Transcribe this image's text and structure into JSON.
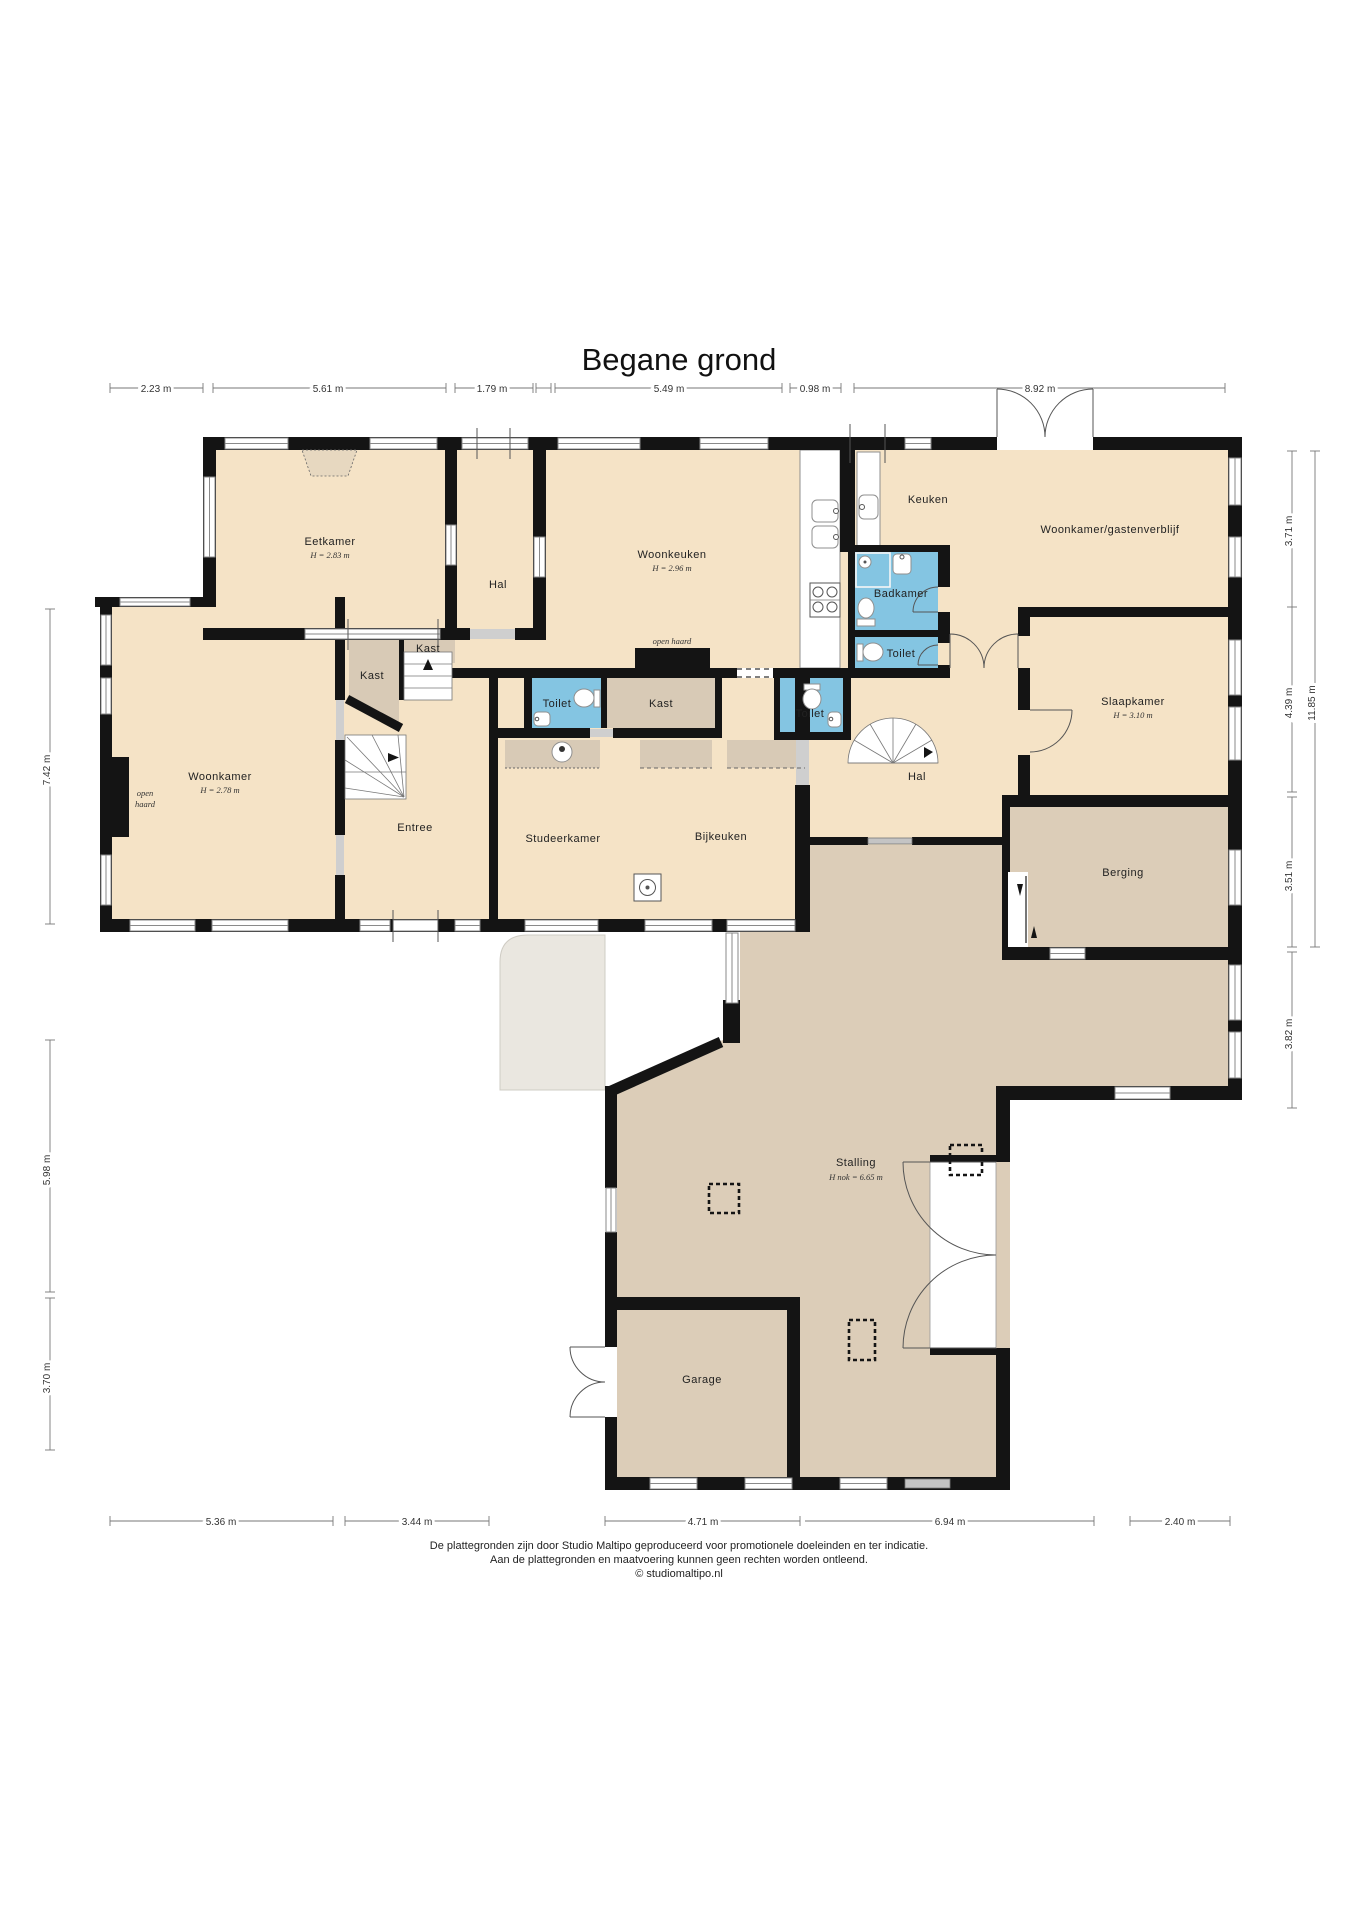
{
  "title": "Begane grond",
  "footer": {
    "line1": "De plattegronden zijn door Studio Maltipo geproduceerd voor promotionele doeleinden en ter indicatie.",
    "line2": "Aan de plattegronden en maatvoering kunnen geen rechten worden ontleend.",
    "line3": "© studiomaltipo.nl"
  },
  "colors": {
    "floor": "#f5e3c6",
    "floor_dark": "#dccdb8",
    "closet": "#d8cab6",
    "wet_room": "#84c5e2",
    "wall": "#141414",
    "outside": "#eae7e0",
    "chimney": "#e7d8c0"
  },
  "rooms": {
    "eetkamer": {
      "label": "Eetkamer",
      "height": "H = 2.83 m"
    },
    "hal_boven": {
      "label": "Hal"
    },
    "woonkeuken": {
      "label": "Woonkeuken",
      "height": "H = 2.96 m"
    },
    "open_haard_keuken": {
      "label": "open haard"
    },
    "keuken": {
      "label": "Keuken"
    },
    "badkamer": {
      "label": "Badkamer"
    },
    "toilet_badkamer": {
      "label": "Toilet"
    },
    "woonkamer_gastenverblijf": {
      "label": "Woonkamer/gastenverblijf"
    },
    "slaapkamer": {
      "label": "Slaapkamer",
      "height": "H = 3.10 m"
    },
    "kast_trap_boven": {
      "label": "Kast"
    },
    "kast_trap": {
      "label": "Kast"
    },
    "woonkamer": {
      "label": "Woonkamer",
      "height": "H = 2.78 m",
      "open_haard_1": "open",
      "open_haard_2": "haard"
    },
    "entree": {
      "label": "Entree"
    },
    "toilet_gang_links": {
      "label": "Toilet"
    },
    "kast_gang": {
      "label": "Kast"
    },
    "toilet_gang_rechts": {
      "label": "Toilet"
    },
    "studeerkamer": {
      "label": "Studeerkamer"
    },
    "bijkeuken": {
      "label": "Bijkeuken"
    },
    "hal_beneden": {
      "label": "Hal"
    },
    "berging": {
      "label": "Berging"
    },
    "stalling": {
      "label": "Stalling",
      "height": "H nok = 6.65 m"
    },
    "garage": {
      "label": "Garage"
    }
  },
  "dimensions": {
    "top": [
      "2.23 m",
      "5.61 m",
      "1.79 m",
      "5.49 m",
      "0.98 m",
      "8.92 m"
    ],
    "left": [
      "7.42 m",
      "5.98 m",
      "3.70 m"
    ],
    "right": [
      "3.71 m",
      "4.39 m",
      "3.51 m",
      "3.82 m",
      "11.85 m"
    ],
    "bottom": [
      "5.36 m",
      "3.44 m",
      "4.71 m",
      "6.94 m",
      "2.40 m"
    ]
  }
}
